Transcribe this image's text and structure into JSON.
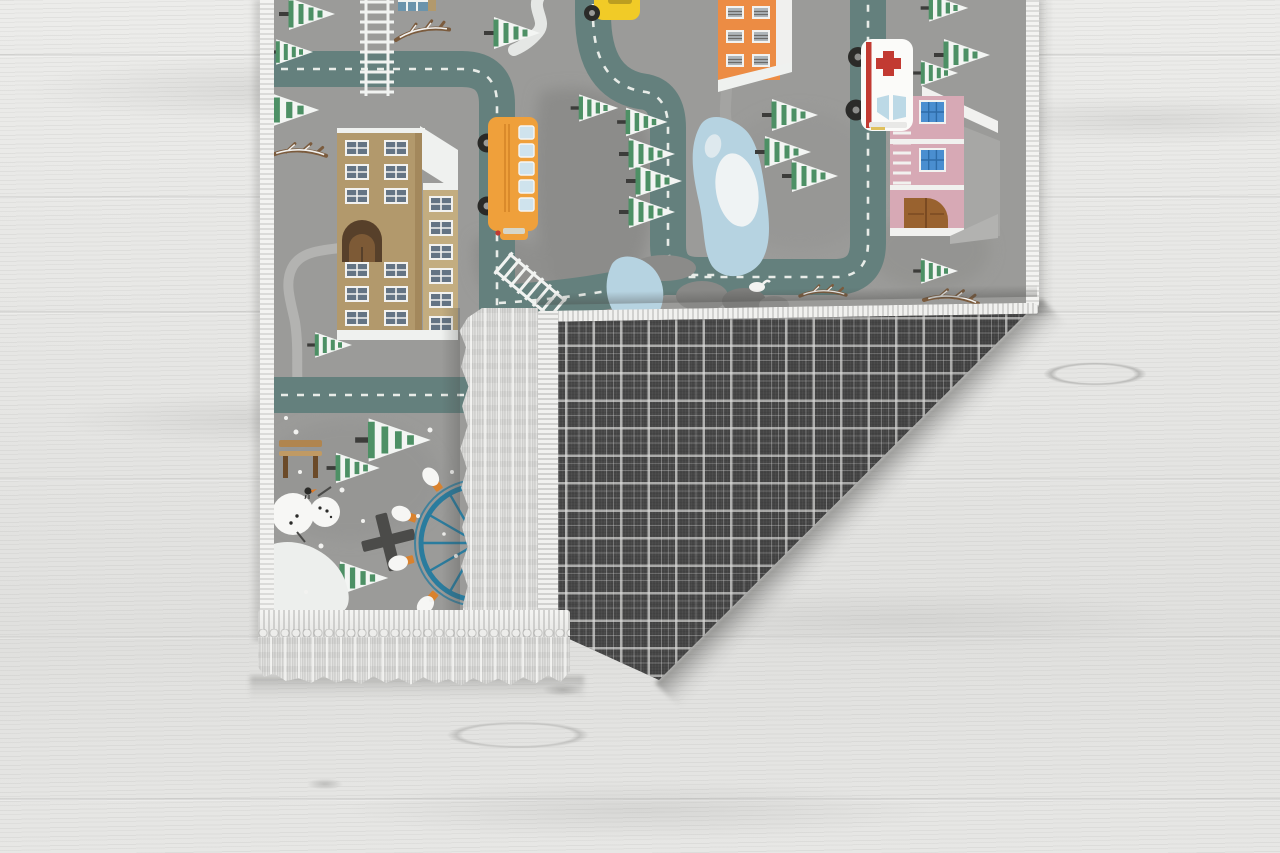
{
  "scene": {
    "label": "Product photo: children's winter city road play rug with its bottom-right corner folded over, revealing a dark tartan plaid backing and pale gray fringe tassels, lying on a whitewashed wood-plank floor",
    "type": "product-photo",
    "floor": {
      "base_color": "#e8e8e6",
      "seam_color": "#787876",
      "grain_color": "#cfcfcd"
    },
    "rug": {
      "theme": "winter city roads play mat",
      "background_color": "#9b9b99",
      "binding_color": "#f2f2f0",
      "fringe_color": "#d8d8d6",
      "road_color": "#64807d",
      "road_dash_color": "#e8ece8",
      "accent_colors": {
        "school_tan": "#b2996c",
        "bus_orange": "#efa03b",
        "building_orange": "#ec8c44",
        "house_pink": "#d7a9b5",
        "ambulance_red": "#c23a32",
        "pond_blue": "#b6d3e1",
        "tree_green": "#4d9065",
        "ferris_wheel_teal": "#2a7c9e",
        "car_yellow": "#f1cb27"
      },
      "elements": [
        "roads with white dashed centerlines",
        "school building with arched door",
        "orange apartment building",
        "pink hospital house",
        "ambulance with red cross",
        "yellow school bus",
        "yellow car",
        "snowy pine trees",
        "frozen pond with ice floes",
        "rocks",
        "railroad crossings",
        "sidewalk path",
        "park bench",
        "snowman with black bird",
        "ferris wheel with gondolas",
        "snow patch",
        "snow dots",
        "bare branches"
      ]
    },
    "flap": {
      "backing_pattern": "tartan plaid",
      "backing_base_color": "#4c4c4c",
      "backing_line_color": "#e6e6e4",
      "binding_color": "#f1f1ef",
      "fringe_color": "#d6d6d4"
    }
  }
}
